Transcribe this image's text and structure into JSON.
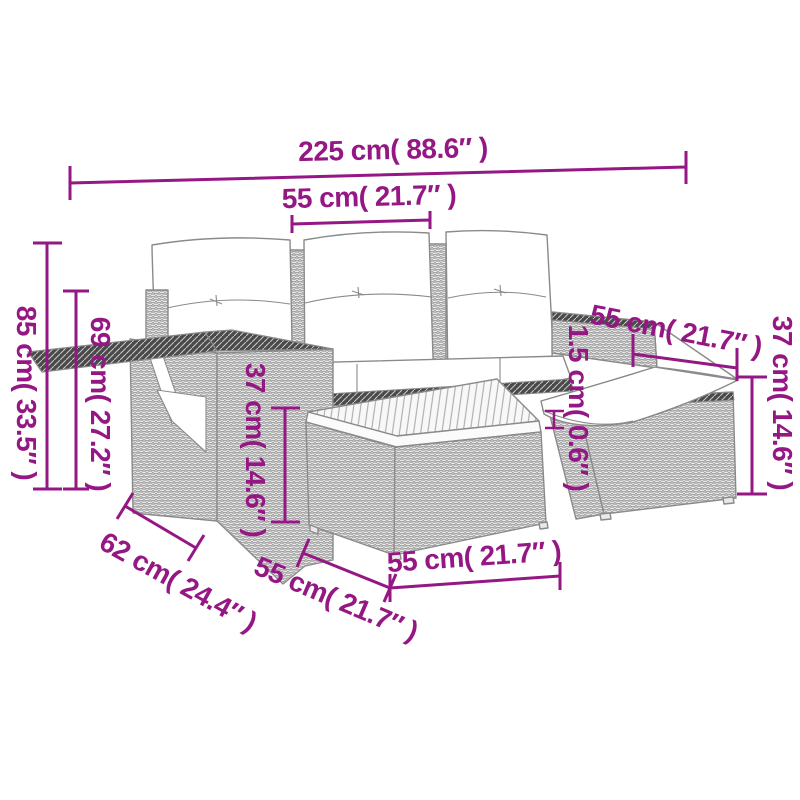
{
  "accent_color": "#951784",
  "drawing_line_color": "#8a8a8a",
  "dimensions": {
    "overall_width": "225 cm( 88.6″ )",
    "seat_width": "55 cm( 21.7″ )",
    "total_height": "85 cm( 33.5″ )",
    "armrest_height": "69 cm( 27.2″ )",
    "seat_height": "37 cm( 14.6″ )",
    "corner_seat_width": "55 cm( 21.7″ )",
    "cushion_thickness": "1.5 cm( 0.6″ )",
    "footstool_height": "37 cm( 14.6″ )",
    "armrest_depth": "62 cm( 24.4″ )",
    "footstool_depth": "55 cm( 21.7″ )",
    "table_width": "55 cm( 21.7″ )"
  }
}
